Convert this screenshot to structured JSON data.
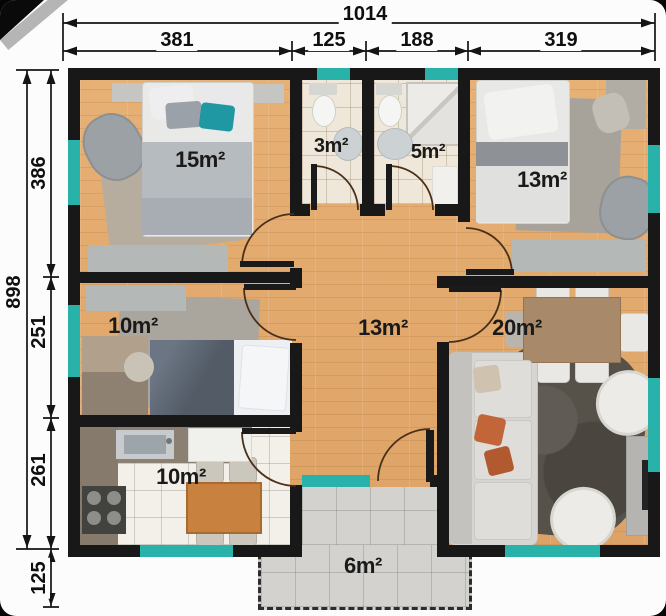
{
  "palette": {
    "wall": "#181818",
    "window_teal": "#29b2aa",
    "wood_floor": "#e3aa6f",
    "tile_floor": "#efe8da",
    "terrace_gray": "#d3d2cf",
    "dimension_text": "#0f0f0f"
  },
  "dimensions": {
    "top": {
      "total": "1014",
      "seg_bedroom": "381",
      "seg_wc": "125",
      "seg_bath": "188",
      "seg_bedroom_right": "319"
    },
    "left": {
      "total": "898",
      "seg_top": "386",
      "seg_middle": "251",
      "seg_bottom": "261",
      "seg_terrace": "125"
    }
  },
  "rooms": {
    "bedroom_top_left": {
      "area": "15m²"
    },
    "wc": {
      "area": "3m²"
    },
    "bathroom": {
      "area": "5m²"
    },
    "bedroom_top_right": {
      "area": "13m²"
    },
    "bedroom_mid_left": {
      "area": "10m²"
    },
    "hallway": {
      "area": "13m²"
    },
    "living_dining": {
      "area": "20m²"
    },
    "kitchen": {
      "area": "10m²"
    },
    "terrace": {
      "area": "6m²"
    }
  }
}
